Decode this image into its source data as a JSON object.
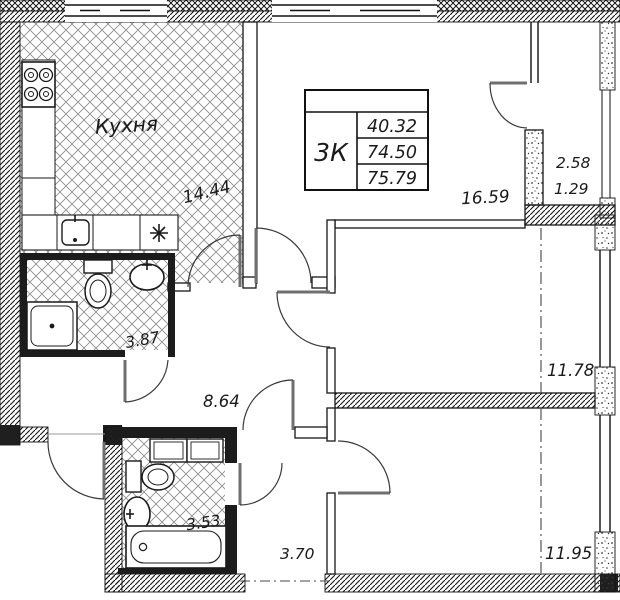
{
  "spec_table": {
    "flat_type": "3К",
    "rows": [
      "40.32",
      "74.50",
      "75.79"
    ]
  },
  "rooms": {
    "kitchen": {
      "name": "Кухня",
      "area": "14.44"
    },
    "living_room": {
      "area": "16.59"
    },
    "loggia": {
      "area": "2.58",
      "area_coef": "1.29"
    },
    "bedroom_top": {
      "area": "11.78"
    },
    "bedroom_bottom": {
      "area": "11.95"
    },
    "hallway": {
      "area": "8.64"
    },
    "bathroom": {
      "area": "3.87"
    },
    "bathroom_small": {
      "area": "3.53"
    },
    "corridor": {
      "area": "3.70"
    }
  },
  "fixtures": {
    "kitchen": [
      "stove-icon",
      "kitchen-sink-icon",
      "appliance-asterisk-icon"
    ],
    "bathroom": [
      "toilet-icon",
      "washbasin-icon",
      "shower-tray-icon"
    ],
    "bathroom_small": [
      "washing-machine-icon",
      "cabinet-icon",
      "toilet-icon",
      "washbasin-icon",
      "bathtub-icon"
    ]
  },
  "colors": {
    "ink": "#1a1a1a",
    "floor_hatch": "#888888",
    "background": "#ffffff"
  }
}
